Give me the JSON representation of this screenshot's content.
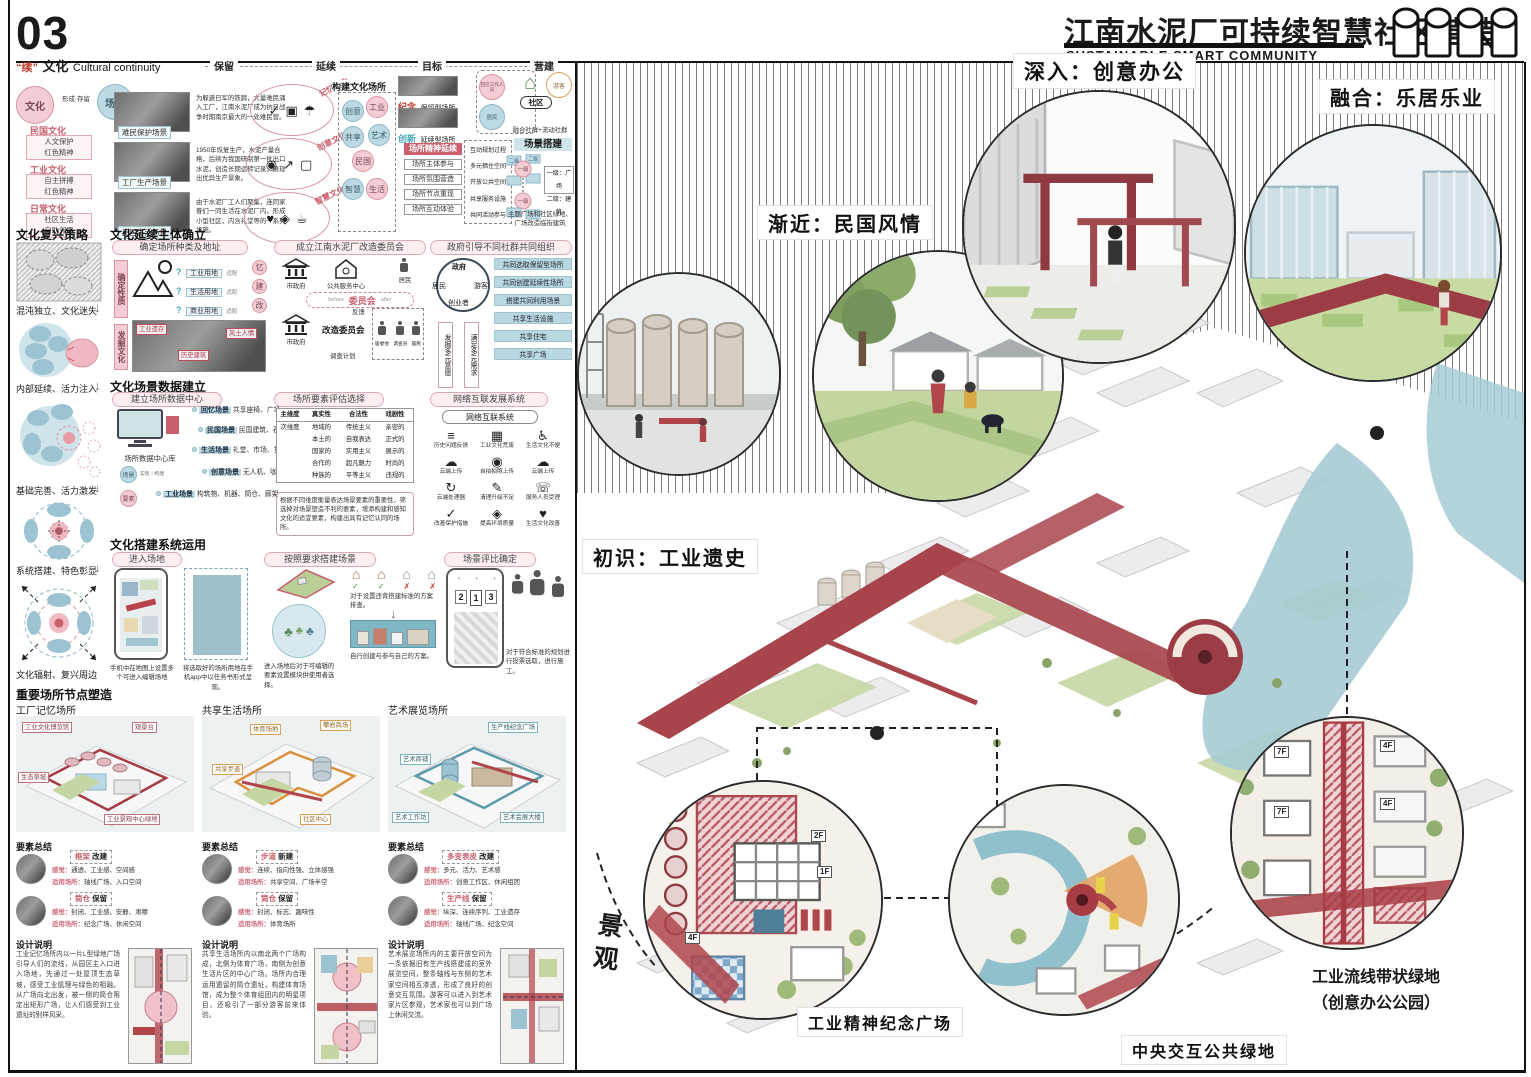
{
  "page": {
    "number": "03"
  },
  "header": {
    "title": "江南水泥厂可持续智慧社区营造",
    "subtitle": "SUSTAINABLE SMART COMMUNITY"
  },
  "intro": {
    "quote": "“续”",
    "title": "文化",
    "title_en": "Cultural continuity",
    "flow": {
      "f0": "保留",
      "f1": "延续",
      "f2": "目标",
      "f3": "营建"
    },
    "origin": {
      "culture": "文化",
      "relation": "形成·存留",
      "scene": "场景"
    },
    "cultures": [
      {
        "name": "民国文化",
        "line1": "人文保护",
        "line2": "红色精神"
      },
      {
        "name": "工业文化",
        "line1": "自主拼搏",
        "line2": "红色精神"
      },
      {
        "name": "日常文化",
        "line1": "社区生活",
        "line2": "自助邻里"
      }
    ],
    "photos": [
      {
        "caption": "难民保护场景",
        "desc": "为躲避日军的铁蹄，大量难民涌入工厂，江南水泥厂成为抗日战争时期南京最大的一处难民营。"
      },
      {
        "caption": "工厂生产场景",
        "desc": "1950年恢复生产，水泥产量合格，后续为我国研制第一批出口水泥，创造长期运转记录，展现出优异生产景象。"
      },
      {
        "caption": "民国生活场景",
        "desc": "由于水泥厂工人们聚集，连同家眷们一同生活在水泥厂内，形成小型社区，内含礼堂等的一系列设施。"
      }
    ],
    "spirits": [
      {
        "label": "记忆文化"
      },
      {
        "label": "创意文化"
      },
      {
        "label": "智慧文化"
      }
    ],
    "build_places": {
      "title": "构建文化场所",
      "n0": "创意",
      "n1": "工业",
      "n2": "共享",
      "n3": "艺术",
      "n4": "民国",
      "n5": "智慧",
      "n6": "生活"
    },
    "place_types": [
      {
        "tag": "纪念",
        "label": "保留型场所"
      },
      {
        "tag": "创新",
        "label": "延续型场所"
      }
    ],
    "spirit_line": "场所精神延续",
    "spirit_items": [
      "场所主体参与",
      "场所氛围营造",
      "场所节点重现",
      "场所互动体验"
    ],
    "goals": [
      "互动规划过程",
      "多元栖住空间",
      "开放公共空间",
      "共享服务设施",
      "共同活动参与"
    ],
    "community": {
      "role1": "回迁工作人员",
      "role2": "游客",
      "role3": "居民",
      "home": "社区",
      "caption": "融合社群+流动社群"
    },
    "scene_build": {
      "title": "场景搭建",
      "lv1": "一级",
      "lv2": "二级",
      "legend1": "一级：广场",
      "legend2": "二级：建筑",
      "caption": "主题广场和社区绿地、广场改造临街建筑"
    }
  },
  "strategy": {
    "title": "文化复兴策略",
    "steps": [
      "混沌独立、文化迷失",
      "内部延续、活力注入",
      "基础完善、活力激发",
      "系统搭建、特色彰显",
      "文化辐射、复兴周边"
    ]
  },
  "subject": {
    "title": "文化延续主体确立",
    "site": {
      "pill": "确定场所种类及地址",
      "v1": "确定性质",
      "v2": "发掘文化",
      "lands": [
        {
          "name": "工业用地",
          "link": "适配",
          "to": "忆"
        },
        {
          "name": "生活用地",
          "link": "适配",
          "to": "建"
        },
        {
          "name": "商业用地",
          "link": "适配",
          "to": "改"
        }
      ],
      "tags": [
        "工业遗存",
        "历史建筑",
        "风土人情"
      ]
    },
    "committee": {
      "pill": "成立江南水泥厂改造委员会",
      "gov": "市政府",
      "center": "公共服务中心",
      "resident": "居民",
      "before": "before",
      "mid": "委员会",
      "after": "after",
      "gov2": "市政府",
      "council": "改造委员会",
      "feedback": "反馈",
      "plan": "调查计划",
      "m1": "居委会",
      "m2": "调查员",
      "m3": "居民"
    },
    "guide": {
      "pill": "政府引导不同社群共同组织",
      "c_top": "政府",
      "c_left": "居民",
      "c_right": "游客",
      "c_bottom": "创业者",
      "v1": "发掘多元意愿",
      "v2": "满足多元需求",
      "items": [
        "共同选取保留型场所",
        "共同创建延续性场所",
        "搭建共同利用场景",
        "共享生活设施",
        "共享住宅",
        "共享广场"
      ]
    }
  },
  "data_center": {
    "title": "文化场景数据建立",
    "hub": {
      "pill": "建立场所数据中心",
      "label": "场所数据中心库",
      "s1": "场景",
      "s2": "要素",
      "link1": "实现",
      "link2": "构建",
      "scenes": [
        {
          "tag": "回忆场景",
          "items": "共享座椅、广场"
        },
        {
          "tag": "民国场景",
          "items": "民国建筑、石路"
        },
        {
          "tag": "生活场景",
          "items": "礼堂、市场、货架"
        },
        {
          "tag": "创意场景",
          "items": "无人机、咖啡、3D打印"
        },
        {
          "tag": "工业场景",
          "items": "构筑物、机器、筒仓、廊架"
        }
      ]
    },
    "evaluate": {
      "pill": "场所要素评估选择",
      "h0": "主维度",
      "h1": "真实性",
      "h2": "合法性",
      "h3": "戏剧性",
      "sub": "次维度",
      "col1": [
        "地域的",
        "本土的",
        "国家的",
        "合作的",
        "种族的"
      ],
      "col2": [
        "传统主义",
        "自我表达",
        "实用主义",
        "超凡魅力",
        "平等主义"
      ],
      "col3": [
        "亲密的",
        "正式的",
        "展示的",
        "时尚的",
        "违规的"
      ],
      "note": "根据不同维度衡量表达场景要素的重要性，筛选掉对场景塑造不利的要素，增添构建和感知文化的适宜要素，构建出具有记忆认同的场所。"
    },
    "network": {
      "pill": "网络互联发展系统",
      "box": "网络互联系统",
      "cells": [
        {
          "icon": "list-icon",
          "label": "历史问题反馈"
        },
        {
          "icon": "factory-icon",
          "label": "工业文化荒废"
        },
        {
          "icon": "wheelchair-icon",
          "label": "生活文化不便"
        },
        {
          "icon": "cloud-upload-icon",
          "label": "云端上传"
        },
        {
          "icon": "camera-icon",
          "label": "自拍拍照上传"
        },
        {
          "icon": "cloud-upload-icon",
          "label": "云端上传"
        },
        {
          "icon": "process-icon",
          "label": "云端处理器"
        },
        {
          "icon": "brush-icon",
          "label": "清理升级不足"
        },
        {
          "icon": "headset-icon",
          "label": "服务人员受理"
        },
        {
          "icon": "check-icon",
          "label": "改善保护措施"
        },
        {
          "icon": "quality-icon",
          "label": "提高环境质量"
        },
        {
          "icon": "heart-icon",
          "label": "生活文化改善"
        }
      ]
    }
  },
  "system_use": {
    "title": "文化搭建系统运用",
    "enter": {
      "pill": "进入场地",
      "cap1": "手机中在地图上设置多个可进入编辑场地",
      "cap2": "将选取好的场所用地在手机app中以任务书形式呈现。"
    },
    "build": {
      "pill": "按照要求搭建场景",
      "cap1": "进入场地后对于可编辑的要素设置模块供使用者选择。",
      "cap2": "对于设置违背搭建标准的方案排查。",
      "cap3": "自行创建与参与自己的方案。"
    },
    "vote": {
      "pill": "场景评比确定",
      "r1": "2",
      "r2": "1",
      "r3": "3",
      "cap": "对于符合标准的规划进行投票选取，进行施工。"
    }
  },
  "nodes": {
    "title": "重要场所节点塑造",
    "summary_title": "要素总结",
    "design_title": "设计说明",
    "feel_label": "感觉：",
    "use_label": "适用场所：",
    "places": [
      {
        "name": "工厂记忆场所",
        "tags": [
          "工业文化博览馆",
          "观景台",
          "生态草坡",
          "工业景观中心绿地"
        ],
        "rows": [
          {
            "tag": "框架",
            "verb": "改建",
            "feel": "通透、工业感、空间感",
            "use": "轴线广场、入口空间"
          },
          {
            "tag": "筒仓",
            "verb": "保留",
            "feel": "封闭、工业感、安静、肃穆",
            "use": "纪念广场、休闲空间"
          }
        ],
        "design": "工业记忆场所内以一片L型绿地广场引导人们的流线，从园区主入口进入场地，先通过一处屋顶生态草坡，感受工业肌理与绿色的相融。从广场向北出发，被一侧的筒仓限定出矩形广场，让人们感受到工业遗址的别样风采。"
      },
      {
        "name": "共享生活场所",
        "tags": [
          "体育场地",
          "攀岩商场",
          "共享步道",
          "社区中心"
        ],
        "rows": [
          {
            "tag": "步道",
            "verb": "新建",
            "feel": "连续、指向性强、立体感强",
            "use": "共享空间、广场半空"
          },
          {
            "tag": "筒仓",
            "verb": "保留",
            "feel": "封闭、标志、趣味性",
            "use": "体育场所"
          }
        ],
        "design": "共享生活场所内以南北两个广场构成，北侧为体育广场，南侧为创意生活片区的中心广场。场所内合理运用遗留的筒仓遗址，构建体育场馆，成为整个体育组团内的明星项目，还吸引了一部分游客前来体验。"
      },
      {
        "name": "艺术展览场所",
        "tags": [
          "艺术商铺",
          "生产线纪念广场",
          "艺术工作坊",
          "艺术会展大楼"
        ],
        "rows": [
          {
            "tag": "多变表皮",
            "verb": "改建",
            "feel": "多元、活力、艺术感",
            "use": "创意工作区、休闲组团"
          },
          {
            "tag": "生产线",
            "verb": "保留",
            "feel": "纵深、连续序列、工业遗存",
            "use": "轴线广场、纪念空间"
          }
        ],
        "design": "艺术展览场所内的主要开放空间为一条依据旧有生产线搭建成的室外展览空间，整条轴线与东侧的艺术家空间相互渗透，形成了良好的创意交互氛围。游客可以进入到艺术家片区参观，艺术家也可以到广场上休闲交流。"
      }
    ]
  },
  "master": {
    "callouts": [
      {
        "label": "初识：工业遗史"
      },
      {
        "label": "渐近：民国风情"
      },
      {
        "label": "深入：创意办公"
      },
      {
        "label": "融合：乐居乐业"
      }
    ],
    "landscape": "景观",
    "details": [
      {
        "label": "工业精神纪念广场"
      },
      {
        "label": "中央交互公共绿地"
      },
      {
        "label": "工业流线带状绿地",
        "label2": "（创意办公公园）"
      }
    ],
    "floors": [
      "7F",
      "4F",
      "2F",
      "1F"
    ]
  }
}
